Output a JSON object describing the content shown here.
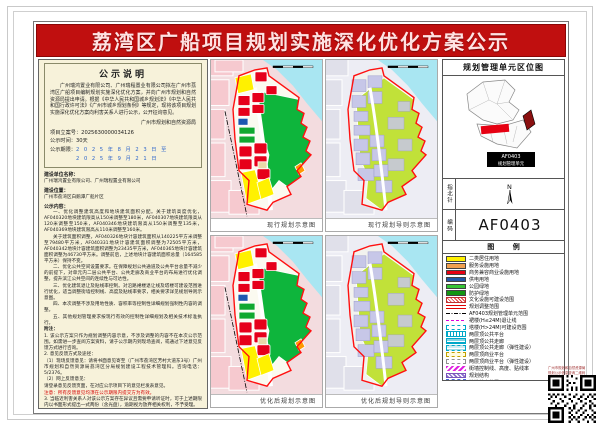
{
  "banner": {
    "title": "荔湾区广船项目规划实施深化优化方案公示"
  },
  "notice": {
    "box_title": "公示说明",
    "paragraph": "广州瑞鸿置业有限公司、广州瑞程置业有限公司拟在广州市荔湾区广船项目编制规划实施深化优化方案，并向广州市规划和自然资源局提出申请。根据《中华人民共和国城乡规划法》《中华人民共和国行政许可法》《广州市城乡规划条例》等规定，现将该项目规划实施深化优化方案向利害关系人进行公示，公开征询意见。",
    "signature": "广州市规划和自然资源局",
    "case_no_label": "项目立案号：",
    "case_no": "2025630000034126",
    "duration_label": "公示时间：",
    "duration": "30天",
    "period_label": "公示期限：",
    "period_start": "2 0 2 5 年 8 月 2 3 日 至",
    "period_end": "2 0 2 5 年 9 月 2 1 日"
  },
  "details": {
    "applicant_label": "建设单位名称：",
    "applicant": "广州瑞鸿置业有限公司、广州瑞程置业有限公司",
    "location_label": "建设位置：",
    "location": "广州市荔湾区白鹅潭广船片区",
    "content_label": "公示内容：",
    "items": [
      "一、优化调整建筑高度和地块建筑面积分配。关于建筑高度优化，AF040320地块建筑限高从150米调整至180米，AF040307地块建筑限高从120米调整至150米，AF040346地块建筑限高从150米调整至135米，AF040369地块建筑限高从110米调整至160米。",
      "关于建筑面积调整，AF040326地块计容建筑面积从140225平方米调整至79480平方米，AF040331地块计容建筑面积调整为72505平方米，AF040342地块计容建筑面积调整为23435平方米，AF040365地块计容建筑面积调整为46730平方米。调整前后，上述地块计容建筑面积总量（164585平方米）保持不变。",
      "二、优化公共空间设置要求。在保障规划公共通道及公共平台总量不减少的前提下，对单元内二层公共平台、公共走廊及商业平台的布局进行优化调整，提升滨江公共空间的连续性与可达性。",
      "三、优化建筑退让及贴线率控制。对沿路裙楼退让线及塔楼可建设范围进行优化，适当调整街墙控制线、高度及贴线率要求，相关要求详见规划导则示意图。",
      "四、本次调整不涉及用地性质、容积率等控制性详细规划强制性内容的调整。",
      "五、其他规划管理要求按现行有效的控制性详细规划及相关技术标准执行。"
    ],
    "notes": [
      {
        "text": "附注：",
        "bold": true
      },
      {
        "text": "1. 该公示方案只作为规划调整内容示意，不涉及调整的内容不在本次公示范围。如需进一步查阅方案资料，请于公示期内到现场查阅，或通过下述意见反馈方式进行咨询。"
      },
      {
        "text": "2. 意见反馈方式及途径："
      },
      {
        "text": "（1）现场反馈意见：请将书面意见寄至（广州市荔湾区芳村大道东3号）广州市规划和自然资源局荔湾区分局规划建设工程技术管理科。咨询电话：5/2376。"
      },
      {
        "text": "（2）网上反馈意见："
      },
      {
        "text": "请登录意见反馈页面，在对应公示项目下的意见栏发表意见。"
      },
      {
        "text": "注意：所有反馈意见均须在公示期限内提交方为有效。",
        "red": true
      },
      {
        "text": "3. 当临近利害关系人对该公示方案存在异议且需要申请听证时，可于上述期限内以书面形式提出一式两份（含光盘），逾期视为放弃相关权利，不予受理。"
      },
      {
        "text": "4. 有效处理意见：对利害关系人提出的意见（包括来电、来访等方式）（可在本局网站查询或到现场下载填写《公示反馈意见函》），经审查属于本次公示范围且于公示期限内反馈的，将作为进一步审查时的参考依据予以研究处理。"
      },
      {
        "text": "5. 查询网址："
      },
      {
        "text": "http://ghzyj.gz.gov.cn/ywpd/cxgh/ghshgsgk/zsgs/",
        "url": true
      }
    ]
  },
  "maps": {
    "captions": [
      "现行规划示意图",
      "现行规划导则示意图",
      "优化后规划示意图",
      "优化后规划导则示意图"
    ]
  },
  "sidebar": {
    "title": "规划管理单元区位图",
    "compass_label": "指北针",
    "north_label": "N",
    "code_label": "编码",
    "unit_code": "AF0403",
    "legend_title": "图 例",
    "locmap_label1": "AF0403",
    "locmap_label2": "规划管理单元",
    "legend": [
      {
        "label": "二类居住用地",
        "type": "solid",
        "color": "#fff100"
      },
      {
        "label": "服务设施用地",
        "type": "solid",
        "color": "#f0a050"
      },
      {
        "label": "商务兼容商业设施用地",
        "type": "solid",
        "color": "#e60012"
      },
      {
        "label": "供电用地",
        "type": "solid",
        "color": "#2158a8"
      },
      {
        "label": "公园绿地",
        "type": "solid",
        "color": "#35c435"
      },
      {
        "label": "防护绿地",
        "type": "solid",
        "color": "#129612"
      },
      {
        "label": "文化设施可建设范围",
        "type": "hatch-red"
      },
      {
        "label": "规划调整范围",
        "type": "dline-red"
      },
      {
        "label": "AF0403规划管理单元范围",
        "type": "dashdot-black"
      },
      {
        "label": "裙楼(H≤24M)退让线",
        "type": "dash-magenta"
      },
      {
        "label": "塔楼(H>24M)可建设范围",
        "type": "dash-cyan"
      },
      {
        "label": "两层顶公共平台",
        "type": "vhatch-cyan"
      },
      {
        "label": "两层顶公共走廊",
        "type": "hlines-cyan"
      },
      {
        "label": "两层顶公共走廊（弹性建设）",
        "type": "dash-cyan2"
      },
      {
        "label": "两层顶商业平台",
        "type": "dash-yellow"
      },
      {
        "label": "两层顶商业平台（弹性建设）",
        "type": "dash-gray"
      },
      {
        "label": "街墙控制线、高度、贴线率",
        "type": "zigzag-magenta"
      },
      {
        "label": "规划结构",
        "type": "hatch-purple"
      },
      {
        "label": "地铁站点位置",
        "type": "dashbox-blue"
      }
    ]
  },
  "qr": {
    "caption_line1": "广州市规划和自然资源局",
    "caption_line2": "规划公示信息查询二维码"
  }
}
